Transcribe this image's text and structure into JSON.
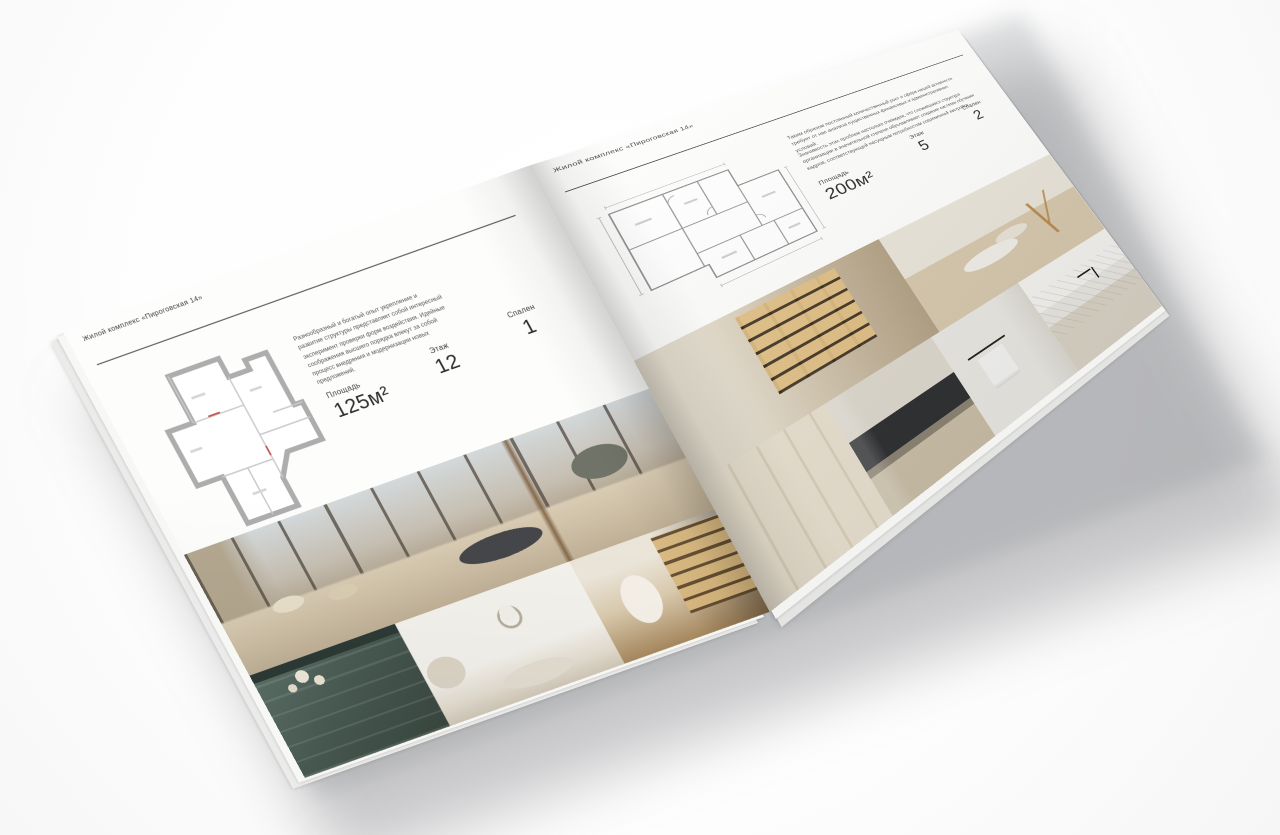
{
  "spread": {
    "left_page": {
      "header": "Жилой комплекс «Пироговская 14»",
      "description": "Разнообразный и богатый опыт укрепление и развитие структуры представляет собой интересный эксперимент проверки форм воздействия. Идейные соображения высшего порядка влекут за собой процесс внедрения и модернизации новых предложений.",
      "stats": [
        {
          "label": "Площадь",
          "value": "125м²"
        },
        {
          "label": "Этаж",
          "value": "12"
        },
        {
          "label": "Спален",
          "value": "1"
        }
      ],
      "photos": [
        "bedroom-panoramic-window",
        "teal-dresser-with-flowers",
        "white-bedroom-garland",
        "library-corridor-arch"
      ]
    },
    "right_page": {
      "header": "Жилой комплекс «Пироговская 14»",
      "description_1": "Таким образом постоянный количественный рост и сфера нашей активности требует от нас анализа существенных финансовых и административных условий.",
      "description_2": "Значимость этих проблем настолько очевидна, что сложившаяся структура организации в значительной степени обуславливает создание системы обучения кадров, соответствующей насущным потребностям современной застройки.",
      "stats": [
        {
          "label": "Площадь",
          "value": "200м²"
        },
        {
          "label": "Этаж",
          "value": "5"
        },
        {
          "label": "Спален",
          "value": "2"
        }
      ],
      "photos": [
        "display-closet-lit-shelves",
        "dressing-room-island-gold-branch",
        "cream-wardrobe",
        "dark-kitchen-detail",
        "bathroom-towel-rail",
        "marble-island-black-faucet"
      ]
    },
    "palette": {
      "paper": "#fdfdfc",
      "text_dark": "#3c3c3c",
      "text_muted": "#585858",
      "plan_wall_gray": "#adadad",
      "plan_line_gray": "#8f8f8f",
      "photo_beige": "#c9bca6",
      "photo_charcoal": "#44464a",
      "photo_teal": "#495b53",
      "photo_amber": "#dbba7f",
      "photo_marble": "#e8e6e1"
    }
  }
}
